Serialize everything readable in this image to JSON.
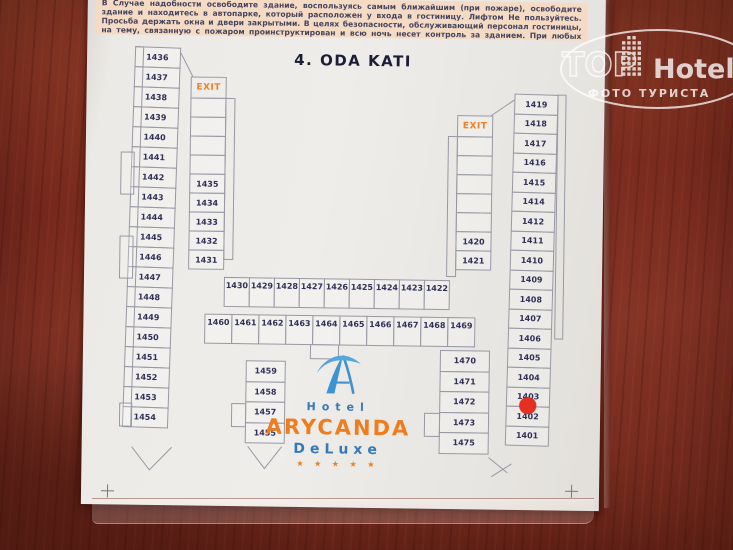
{
  "instructions": {
    "text": "В Случае надобности освободите здание, воспользуясь самым ближайшим (при пожаре), освободите здание и находитесь в автопарке, который расположен у входа в гостиницу. Лифтом Не пользуйтесь. Просьба держать окна и двери закрытыми. В целях безопасности, обслуживающий персонал гостиницы, на тему, связанную с пожаром проинструктирован и всю ночь несет контроль за зданием.    При любых экстренных случаях звоните в отдел телефонной связи."
  },
  "title": "4. ODA KATI",
  "exits": {
    "left": "EXIT",
    "right": "EXIT"
  },
  "logo": {
    "hotel": "Hotel",
    "name": "ARYCANDA",
    "deluxe": "DeLuxe",
    "stars": "★ ★ ★ ★ ★"
  },
  "watermark": {
    "top": "TOP",
    "hotels": "Hotels",
    "subtitle": "ФОТО ТУРИСТА"
  },
  "colors": {
    "wood": "#7c2d20",
    "sheet": "#eceae6",
    "band": "#f5dbc4",
    "accent_orange": "#ef7d1f",
    "logo_blue": "#3579b8",
    "red_dot": "#e53020",
    "plan_line": "#9898a4",
    "room_text": "#30305a"
  },
  "plan": {
    "left_outer_col": [
      "1436",
      "1437",
      "1438",
      "1439",
      "1440",
      "1441",
      "1442",
      "1443",
      "1444",
      "1445",
      "1446",
      "1447",
      "1448",
      "1449",
      "1450",
      "1451",
      "1452",
      "1453",
      "1454"
    ],
    "inner_left_col": [
      "",
      "",
      "",
      "",
      "1435",
      "1434",
      "1433",
      "1432",
      "1431"
    ],
    "row_top": [
      "1430",
      "1429",
      "1428",
      "1427",
      "1426",
      "1425",
      "1424",
      "1423",
      "1422"
    ],
    "row_bottom": [
      "1460",
      "1461",
      "1462",
      "1463",
      "1464",
      "1465",
      "1466",
      "1467",
      "1468",
      "1469"
    ],
    "inner_bottom_left_col": [
      "1459",
      "1458",
      "1457",
      "1455"
    ],
    "mid_right_col": [
      "1470",
      "1471",
      "1472",
      "1473",
      "1475"
    ],
    "inner_right_col": [
      "",
      "",
      "",
      "",
      "",
      "1420",
      "1421"
    ],
    "right_outer_col": [
      "1419",
      "1418",
      "1417",
      "1416",
      "1415",
      "1414",
      "1412",
      "1411",
      "1410",
      "1409",
      "1408",
      "1407",
      "1406",
      "1405",
      "1404",
      "1403",
      "1402",
      "1401"
    ],
    "marked_room": "1403"
  }
}
